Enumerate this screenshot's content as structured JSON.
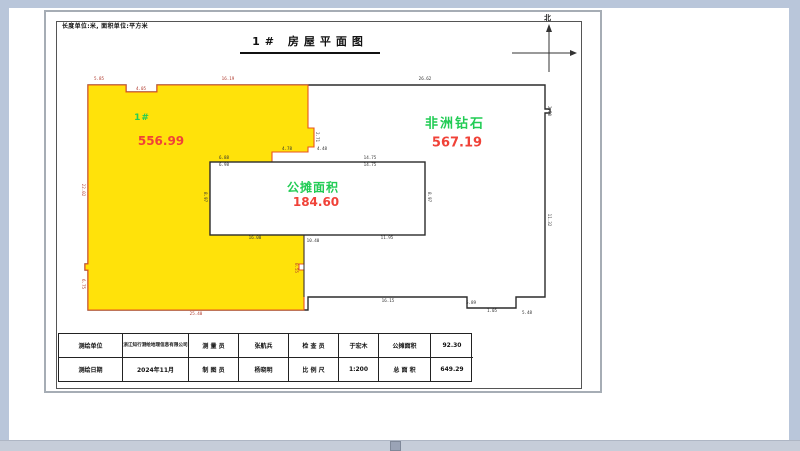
{
  "sheet": {
    "units_note": "长度单位:米, 面积单位:平方米",
    "title": "1# 房屋平面图",
    "north_label": "北"
  },
  "plan": {
    "regions": [
      {
        "label": "1#",
        "area": "556.99"
      },
      {
        "label": "非洲钻石",
        "area": "567.19"
      },
      {
        "label": "公摊面积",
        "area": "184.60"
      }
    ],
    "colors": {
      "region_fill": "#ffe20a",
      "region_outline": "#e8551e",
      "plan_outline": "#2b2b2b",
      "label_green": "#22cc55",
      "area_red": "#f04238",
      "dim_dark": "#333333",
      "dim_red": "#b03a2e",
      "chrome_blue": "#b9c6da"
    },
    "dimensions": [
      {
        "t": "5.85",
        "x": 99,
        "y": 79,
        "r": 0,
        "c": "red"
      },
      {
        "t": "4.05",
        "x": 141,
        "y": 89,
        "r": 0,
        "c": "red"
      },
      {
        "t": "16.19",
        "x": 228,
        "y": 79,
        "r": 0,
        "c": "red"
      },
      {
        "t": "26.62",
        "x": 425,
        "y": 79,
        "r": 0,
        "c": "dark"
      },
      {
        "t": "2.71",
        "x": 317,
        "y": 137,
        "r": 90,
        "c": "dark"
      },
      {
        "t": "4.78",
        "x": 287,
        "y": 149,
        "r": 0,
        "c": "dark"
      },
      {
        "t": "4.48",
        "x": 322,
        "y": 149,
        "r": 0,
        "c": "dark"
      },
      {
        "t": "6.88",
        "x": 224,
        "y": 158,
        "r": 0,
        "c": "dark"
      },
      {
        "t": "6.98",
        "x": 224,
        "y": 165,
        "r": 0,
        "c": "dark"
      },
      {
        "t": "14.75",
        "x": 370,
        "y": 158,
        "r": 0,
        "c": "dark"
      },
      {
        "t": "14.75",
        "x": 370,
        "y": 165,
        "r": 0,
        "c": "dark"
      },
      {
        "t": "8.97",
        "x": 205,
        "y": 197,
        "r": 90,
        "c": "dark"
      },
      {
        "t": "8.97",
        "x": 429,
        "y": 197,
        "r": 90,
        "c": "dark"
      },
      {
        "t": "16.00",
        "x": 255,
        "y": 238,
        "r": 0,
        "c": "dark"
      },
      {
        "t": "10.40",
        "x": 313,
        "y": 241,
        "r": 0,
        "c": "dark"
      },
      {
        "t": "11.95",
        "x": 387,
        "y": 238,
        "r": 0,
        "c": "dark"
      },
      {
        "t": "22.02",
        "x": 83,
        "y": 190,
        "r": 90,
        "c": "red"
      },
      {
        "t": "6.75",
        "x": 83,
        "y": 284,
        "r": 90,
        "c": "red"
      },
      {
        "t": "0.55",
        "x": 296,
        "y": 268,
        "r": 90,
        "c": "red"
      },
      {
        "t": "25.40",
        "x": 196,
        "y": 314,
        "r": 0,
        "c": "red"
      },
      {
        "t": "16.15",
        "x": 388,
        "y": 301,
        "r": 0,
        "c": "dark"
      },
      {
        "t": "5.89",
        "x": 471,
        "y": 303,
        "r": 0,
        "c": "dark"
      },
      {
        "t": "1.05",
        "x": 492,
        "y": 311,
        "r": 0,
        "c": "dark"
      },
      {
        "t": "5.48",
        "x": 527,
        "y": 313,
        "r": 0,
        "c": "dark"
      },
      {
        "t": "2.50",
        "x": 549,
        "y": 111,
        "r": 90,
        "c": "dark"
      },
      {
        "t": "11.32",
        "x": 549,
        "y": 220,
        "r": 90,
        "c": "dark"
      }
    ]
  },
  "title_block": {
    "rows": [
      [
        "测绘单位",
        "浙江知行测绘地理信息有限公司",
        "测 量 员",
        "张航兵",
        "检 查 员",
        "于宏木",
        "公摊面积",
        "92.30"
      ],
      [
        "测绘日期",
        "2024年11月",
        "制 图 员",
        "杨晓明",
        "比 例 尺",
        "1:200",
        "总 面 积",
        "649.29"
      ]
    ]
  }
}
